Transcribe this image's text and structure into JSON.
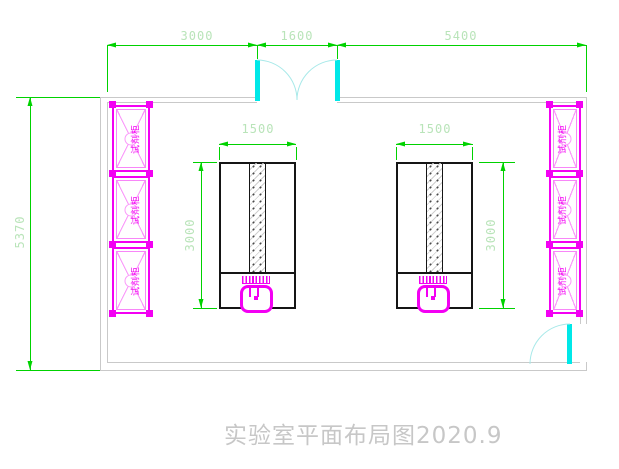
{
  "title": {
    "text": "实验室平面布局图2020.9"
  },
  "dims": {
    "top_left": "3000",
    "top_middle": "1600",
    "top_right": "5400",
    "room_height": "5370",
    "bench_width": "1500",
    "bench_length": "3000"
  },
  "cabinets": {
    "label": "试剂柜"
  },
  "colors": {
    "dimension_line": "#00d200",
    "dimension_text": "#b9e4b9",
    "wall": "#c9c9c9",
    "door_leaf": "#00e8e8",
    "door_arc": "#a8e9e9",
    "cabinet": "#f300f3",
    "cabinet_light": "#fa9bfa",
    "bench_outline": "#151515",
    "title_text": "#c7c7c7"
  }
}
